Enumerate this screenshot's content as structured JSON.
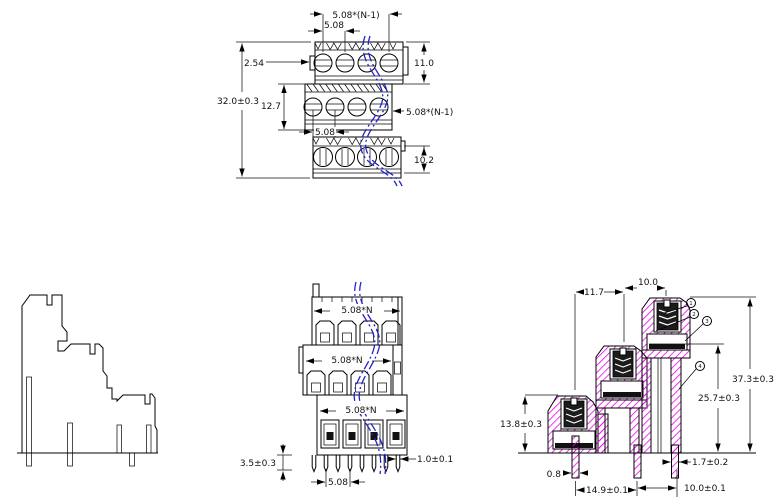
{
  "views": {
    "front": {
      "dims": {
        "pitch_group_top": "5.08*(N-1)",
        "pitch_top": "5.08",
        "row_offset": "2.54",
        "tier1_h": "11.0",
        "total_h": "32.0±0.3",
        "tier2_h": "12.7",
        "pitch_group_mid": "5.08*(N-1)",
        "pitch_mid": "5.08",
        "tier3_h": "10.2"
      }
    },
    "wire_entry": {
      "dims": {
        "width_top": "5.08*N",
        "width_mid": "5.08*N",
        "width_bot": "5.08*N",
        "pin_projection": "3.5±0.3",
        "pin_width": "1.0±0.1",
        "pin_pitch": "5.08"
      }
    },
    "section": {
      "dims": {
        "step_upper": "11.7",
        "step_top": "10.0",
        "height_total": "37.3±0.3",
        "height_mid": "25.7±0.3",
        "height_low": "13.8±0.3",
        "pin_width_left": "0.8",
        "pin_span_left": "14.9±0.1",
        "pin_span_right": "10.0±0.1",
        "pin_width_right": "1.7±0.2"
      },
      "callouts": {
        "c1": "1",
        "c2": "2",
        "c3": "3",
        "c4": "4"
      }
    },
    "colors": {
      "hatch": "#ee00ee",
      "break_line": "#2222cc",
      "line": "#000000"
    }
  }
}
